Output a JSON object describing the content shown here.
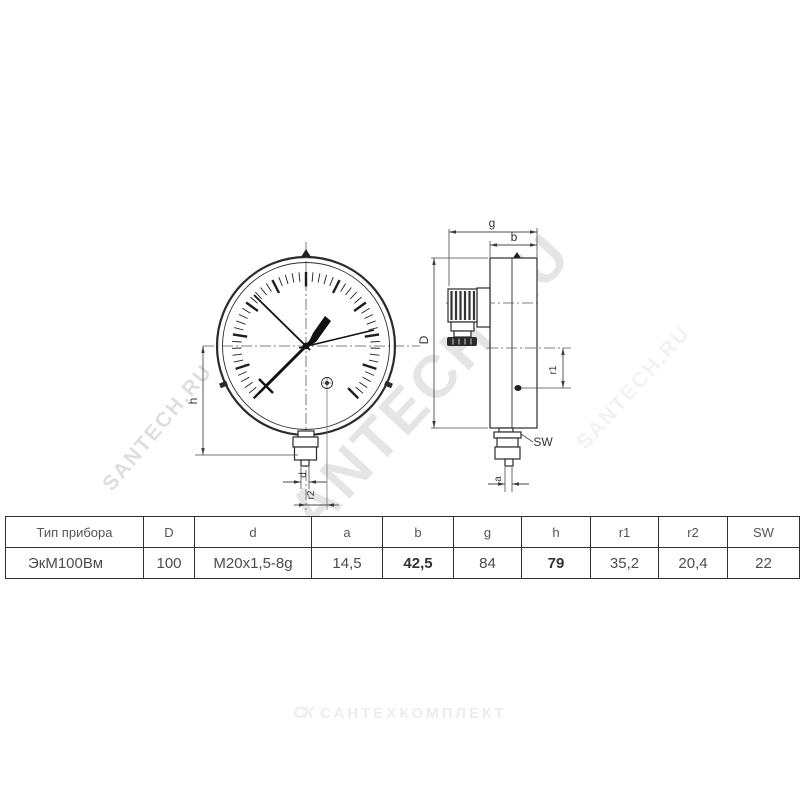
{
  "watermarks": {
    "main": "SANTECH.RU",
    "left": "SANTECH.RU",
    "right": "SANTECH.RU"
  },
  "brand": {
    "mark": "СК",
    "name": "САНТЕХКОМПЛЕКТ"
  },
  "drawing": {
    "labels": {
      "h": "h",
      "d": "d",
      "r2": "r2",
      "g": "g",
      "b": "b",
      "D": "D",
      "r1": "r1",
      "SW": "SW",
      "a": "a"
    }
  },
  "table": {
    "headers": [
      "Тип прибора",
      "D",
      "d",
      "a",
      "b",
      "g",
      "h",
      "r1",
      "r2",
      "SW"
    ],
    "row": [
      "ЭкМ100Вм",
      "100",
      "M20x1,5-8g",
      "14,5",
      "42,5",
      "84",
      "79",
      "35,2",
      "20,4",
      "22"
    ],
    "bold_cols": [
      4,
      6
    ]
  }
}
